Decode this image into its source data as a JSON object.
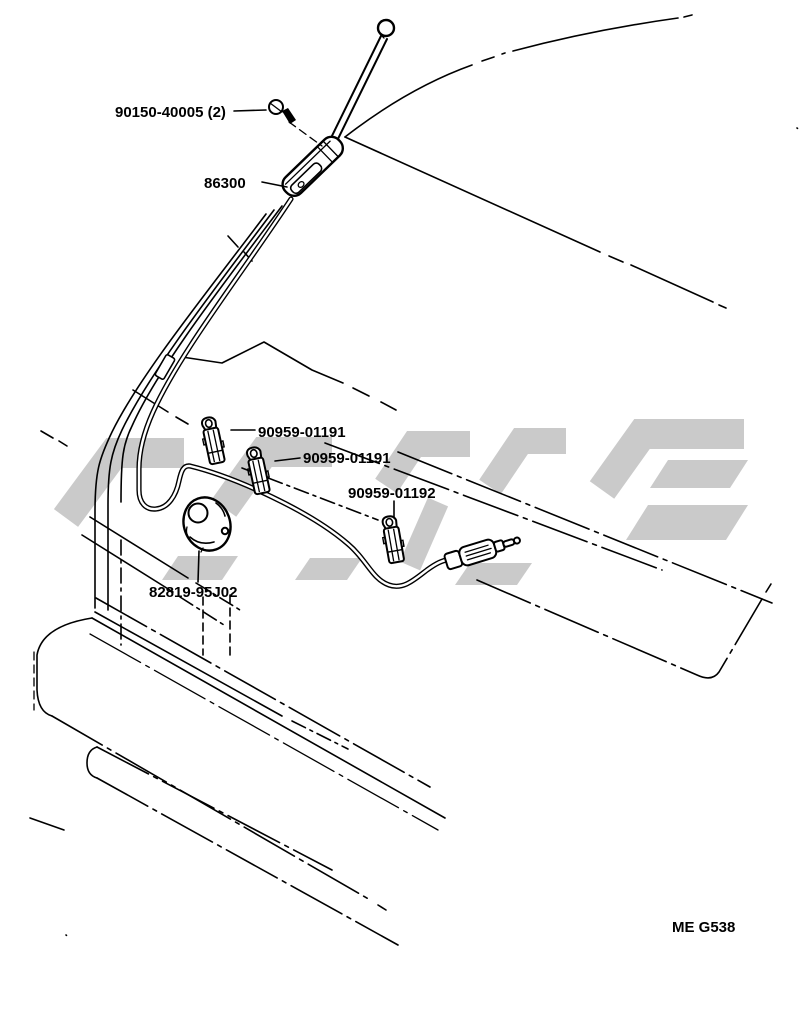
{
  "diagram": {
    "labels": {
      "screw": "90150-40005 (2)",
      "antenna": "86300",
      "clip1": "90959-01191",
      "clip2": "90959-01191",
      "clip3": "90959-01192",
      "grommet": "82819-95J02"
    },
    "figure_code": "ME G538",
    "colors": {
      "line": "#000000",
      "watermark": "#cacaca",
      "background": "#ffffff"
    }
  }
}
